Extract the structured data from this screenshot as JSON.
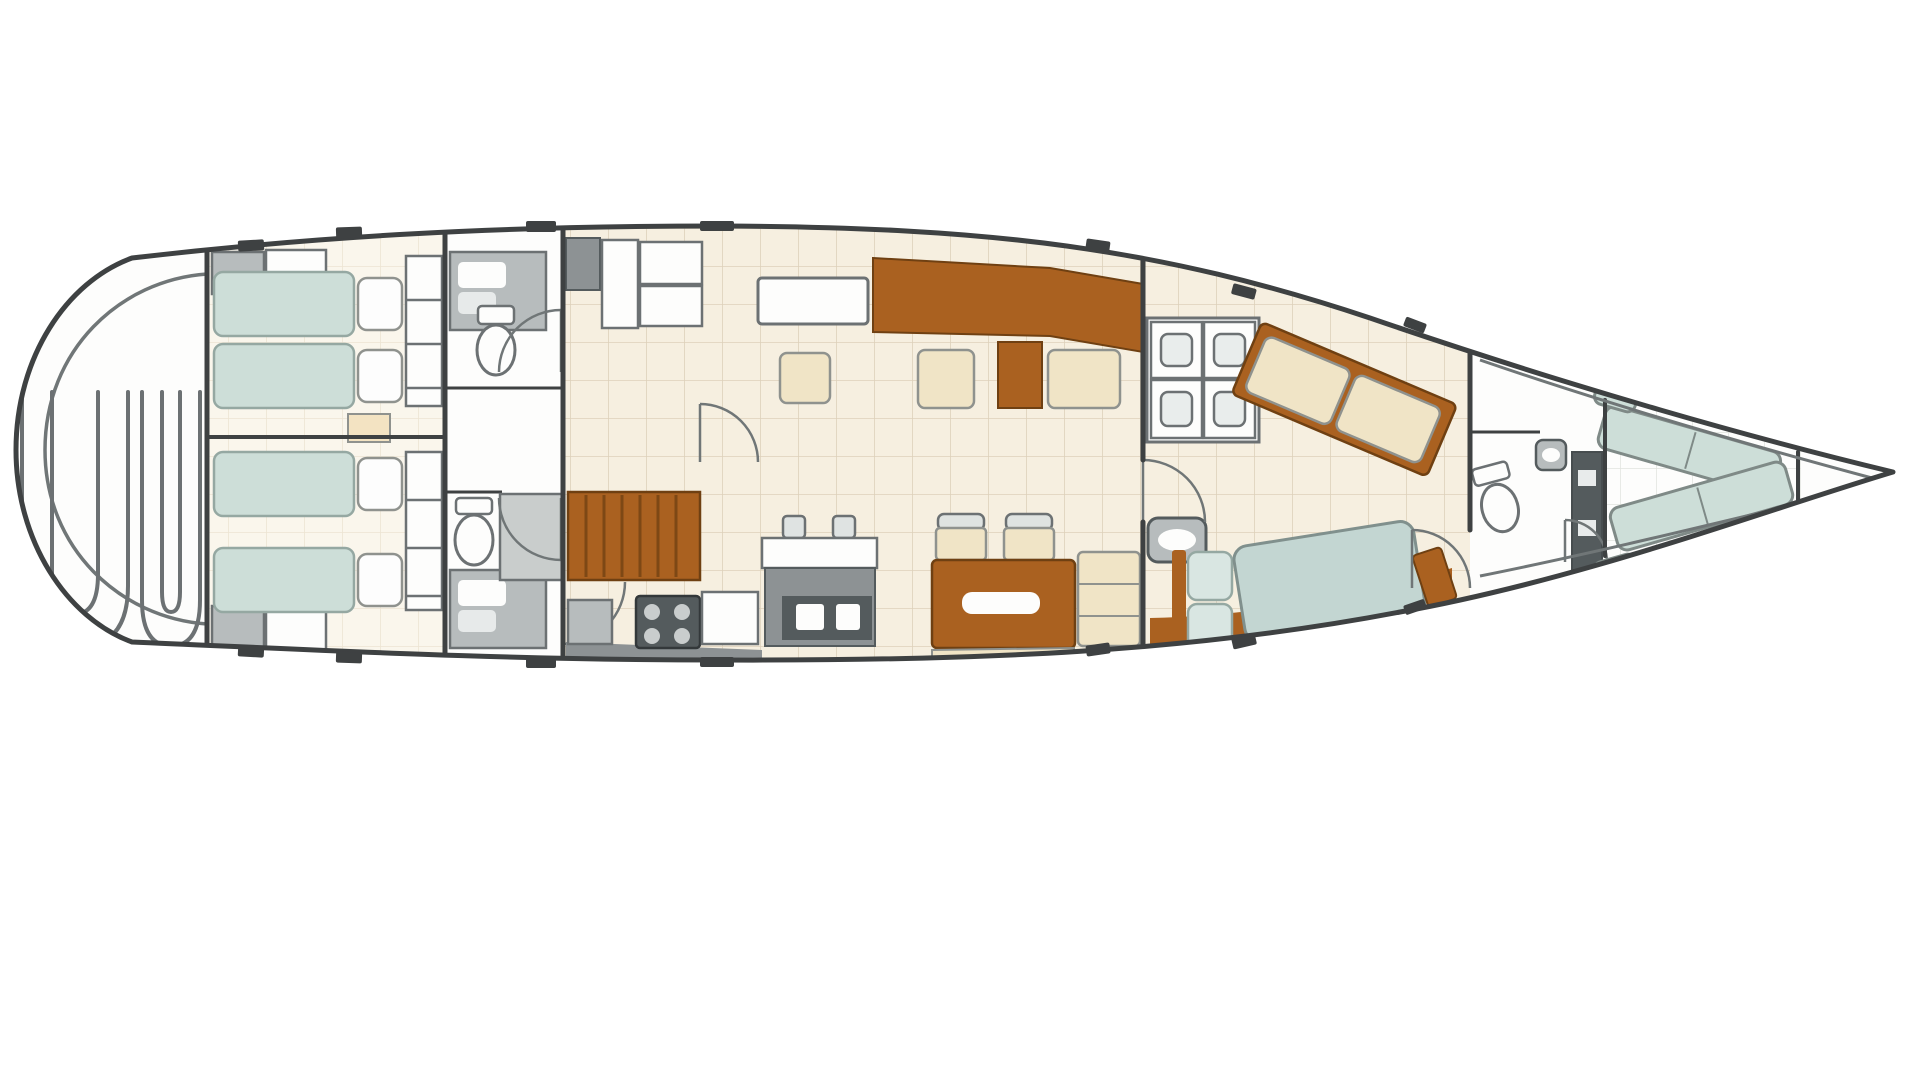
{
  "page": {
    "title": "Sailing yacht interior layout plan, bow to the right",
    "background": "#ffffff"
  },
  "plan": {
    "vessel_type": "sailing-yacht-floor-plan",
    "orientation": {
      "bow": "right",
      "stern": "left"
    },
    "canvas": {
      "width": 1920,
      "height": 1080
    },
    "palette": {
      "hull": "#3e4142",
      "trim": "#707677",
      "floor": "#f6efe0",
      "grid": "#ddd1ba",
      "warmfloor": "#faf6ec",
      "gridcool": "#e2e3de",
      "wood": "#aa6120",
      "woodedge": "#6f4012",
      "cream": "#f0e4c6",
      "creamedge": "#8f928e",
      "teal": "#cdded8",
      "tealedge": "#95a8a2",
      "bedteal": "#c3d6d2",
      "pillow": "#fdfdfd",
      "fixlight": "#b7bcbd",
      "fixmid": "#8d9294",
      "fixdark": "#545b5d",
      "fixedge": "#6c7173",
      "white": "#fdfdfc",
      "landing": "#c9cdcc"
    },
    "rooms": [
      {
        "id": "cockpit",
        "label": "Aft cockpit with twin helm benches"
      },
      {
        "id": "aft-cabin-port",
        "label": "Aft twin cabin, port side"
      },
      {
        "id": "aft-cabin-starboard",
        "label": "Aft twin cabin, starboard side"
      },
      {
        "id": "head-port",
        "label": "Aft head with toilet and vanity, port"
      },
      {
        "id": "head-starboard",
        "label": "Aft head with toilet and vanity, starboard"
      },
      {
        "id": "companionway",
        "label": "Companionway stairs and landing"
      },
      {
        "id": "galley",
        "label": "Galley with island, sinks and stove"
      },
      {
        "id": "salon",
        "label": "Salon and dining area with table and chairs"
      },
      {
        "id": "owners-cabin",
        "label": "Owner's cabin with double berth, sofa and lockers"
      },
      {
        "id": "forward-head",
        "label": "Forward head with toilet, sink and locker"
      },
      {
        "id": "bow-lounge",
        "label": "Bow V-shaped seating"
      },
      {
        "id": "forepeak",
        "label": "Forepeak locker"
      }
    ]
  }
}
